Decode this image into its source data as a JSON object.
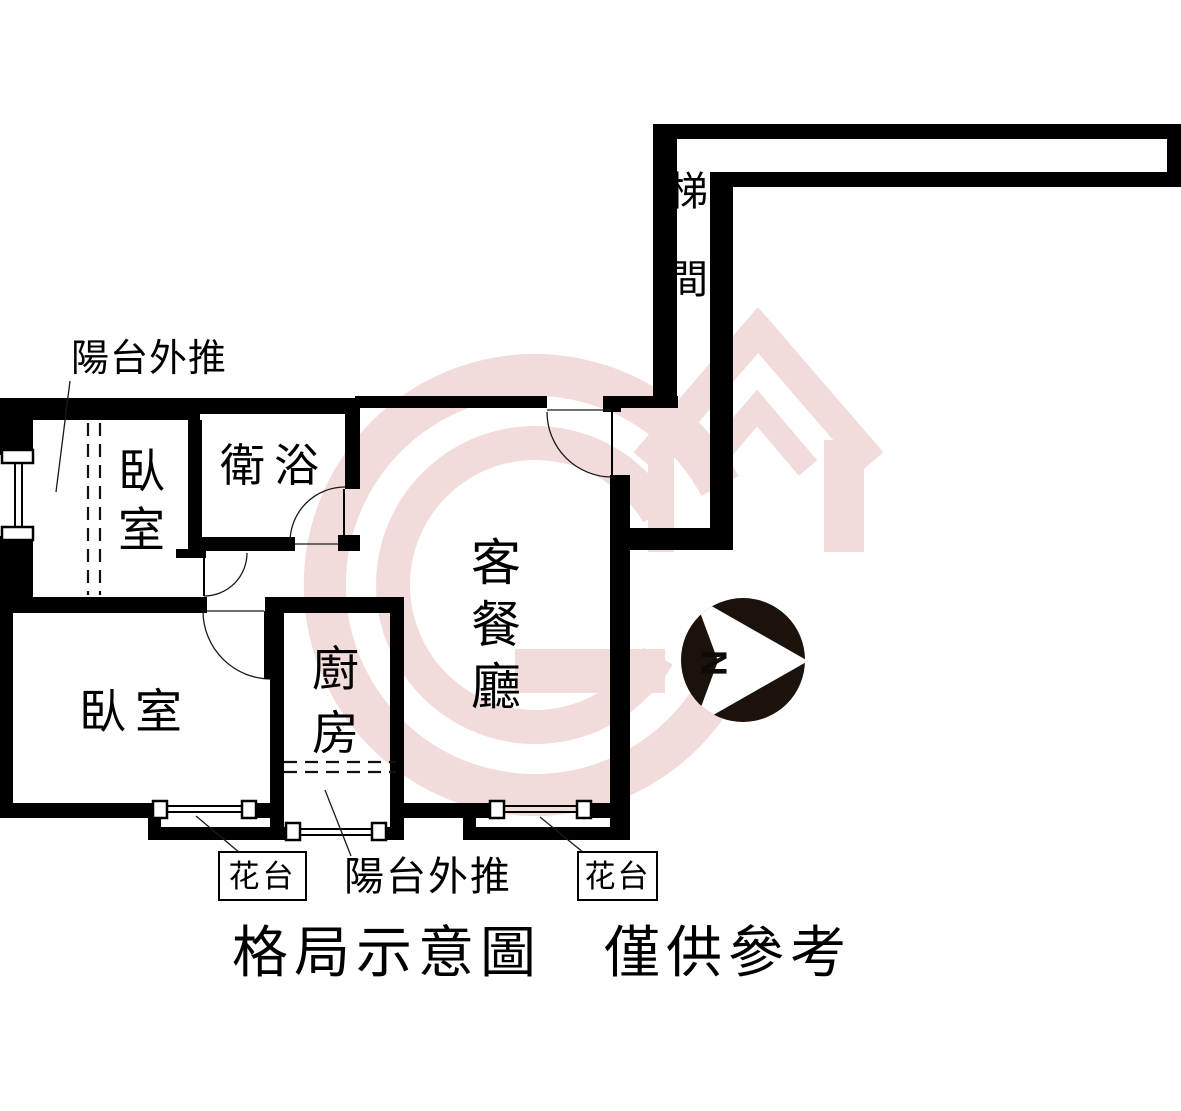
{
  "colors": {
    "paper": "#ffffff",
    "wall": "#000000",
    "pink": "#f2dbdb",
    "compass": "#1a120b"
  },
  "rooms": {
    "stairwell": {
      "label": "梯間"
    },
    "bedroom_upper": {
      "label": "臥室"
    },
    "bathroom": {
      "label": "衛浴"
    },
    "bedroom_lower": {
      "label": "臥室"
    },
    "kitchen": {
      "label": "廚房"
    },
    "living_dining": {
      "label": "客餐廳"
    }
  },
  "annotations": {
    "balcony_push_top": "陽台外推",
    "balcony_push_bottom": "陽台外推",
    "planter_left": "花台",
    "planter_right": "花台"
  },
  "compass": {
    "letter": "N"
  },
  "footer": {
    "title": "格局示意圖　僅供參考"
  }
}
